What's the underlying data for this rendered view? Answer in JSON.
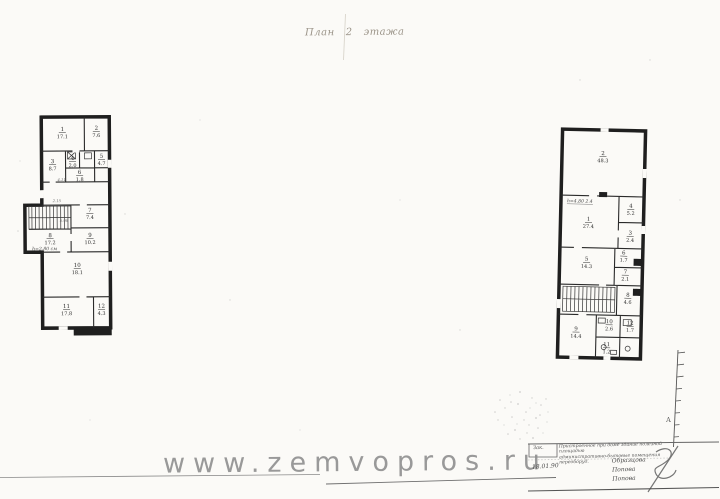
{
  "page": {
    "background": "#fbfaf7",
    "title": "План   2   этажа",
    "watermark": "www.zemvopros.ru"
  },
  "colors": {
    "ink": "#1f1f1f",
    "handwriting": "#4c4c4c",
    "watermark": "#8f8f8f",
    "paper": "#fbfaf7"
  },
  "plans": {
    "left": {
      "rooms": [
        {
          "num": "1",
          "area": "17.1",
          "x": 63,
          "y": 131
        },
        {
          "num": "2",
          "area": "7.6",
          "x": 97,
          "y": 130
        },
        {
          "num": "3",
          "area": "8.7",
          "x": 53,
          "y": 163
        },
        {
          "num": "4",
          "area": "2.0",
          "x": 73,
          "y": 160
        },
        {
          "num": "5",
          "area": "4.7",
          "x": 102,
          "y": 158
        },
        {
          "num": "6",
          "area": "1.8",
          "x": 80,
          "y": 174
        },
        {
          "num": "7",
          "area": "7.4",
          "x": 90,
          "y": 212
        },
        {
          "num": "8",
          "area": "17.2",
          "x": 50,
          "y": 237
        },
        {
          "num": "9",
          "area": "10.2",
          "x": 90,
          "y": 237
        },
        {
          "num": "10",
          "area": "18.1",
          "x": 77,
          "y": 267
        },
        {
          "num": "11",
          "area": "17.8",
          "x": 66,
          "y": 308
        },
        {
          "num": "12",
          "area": "4.3",
          "x": 101,
          "y": 308
        }
      ],
      "stair_note": "h=2.80 см",
      "annotations": [
        {
          "t": "5.98",
          "x": 64,
          "y": 222
        },
        {
          "t": "4.11",
          "x": 62,
          "y": 181
        },
        {
          "t": "2.15",
          "x": 57,
          "y": 202
        }
      ]
    },
    "right": {
      "rooms": [
        {
          "num": "2",
          "area": "48.3",
          "x": 601,
          "y": 155
        },
        {
          "num": "1",
          "area": "27.4",
          "x": 588,
          "y": 221
        },
        {
          "num": "4",
          "area": "5.2",
          "x": 630,
          "y": 207
        },
        {
          "num": "3",
          "area": "2.4",
          "x": 630,
          "y": 234
        },
        {
          "num": "5",
          "area": "14.3",
          "x": 587,
          "y": 261
        },
        {
          "num": "6",
          "area": "1.7",
          "x": 624,
          "y": 254
        },
        {
          "num": "7",
          "area": "2.1",
          "x": 626,
          "y": 273
        },
        {
          "num": "8",
          "area": "4.6",
          "x": 629,
          "y": 296
        },
        {
          "num": "9",
          "area": "14.4",
          "x": 578,
          "y": 331
        },
        {
          "num": "10",
          "area": "2.6",
          "x": 611,
          "y": 323
        },
        {
          "num": "11",
          "area": "1.2",
          "x": 609,
          "y": 346
        },
        {
          "num": "12",
          "area": "1.7",
          "x": 632,
          "y": 324
        }
      ],
      "height_note": "h=4.80  2.4"
    }
  },
  "ruler": {
    "label": "А"
  },
  "stamp": {
    "order_label": "Зак.",
    "description_line1": "Пристроенное при доме здание полезной площадью",
    "description_line2": "административно-бытовые помещения переоборуд.",
    "date": "18.01.90",
    "names": [
      "Образцова",
      "Попова",
      "Попова"
    ]
  }
}
